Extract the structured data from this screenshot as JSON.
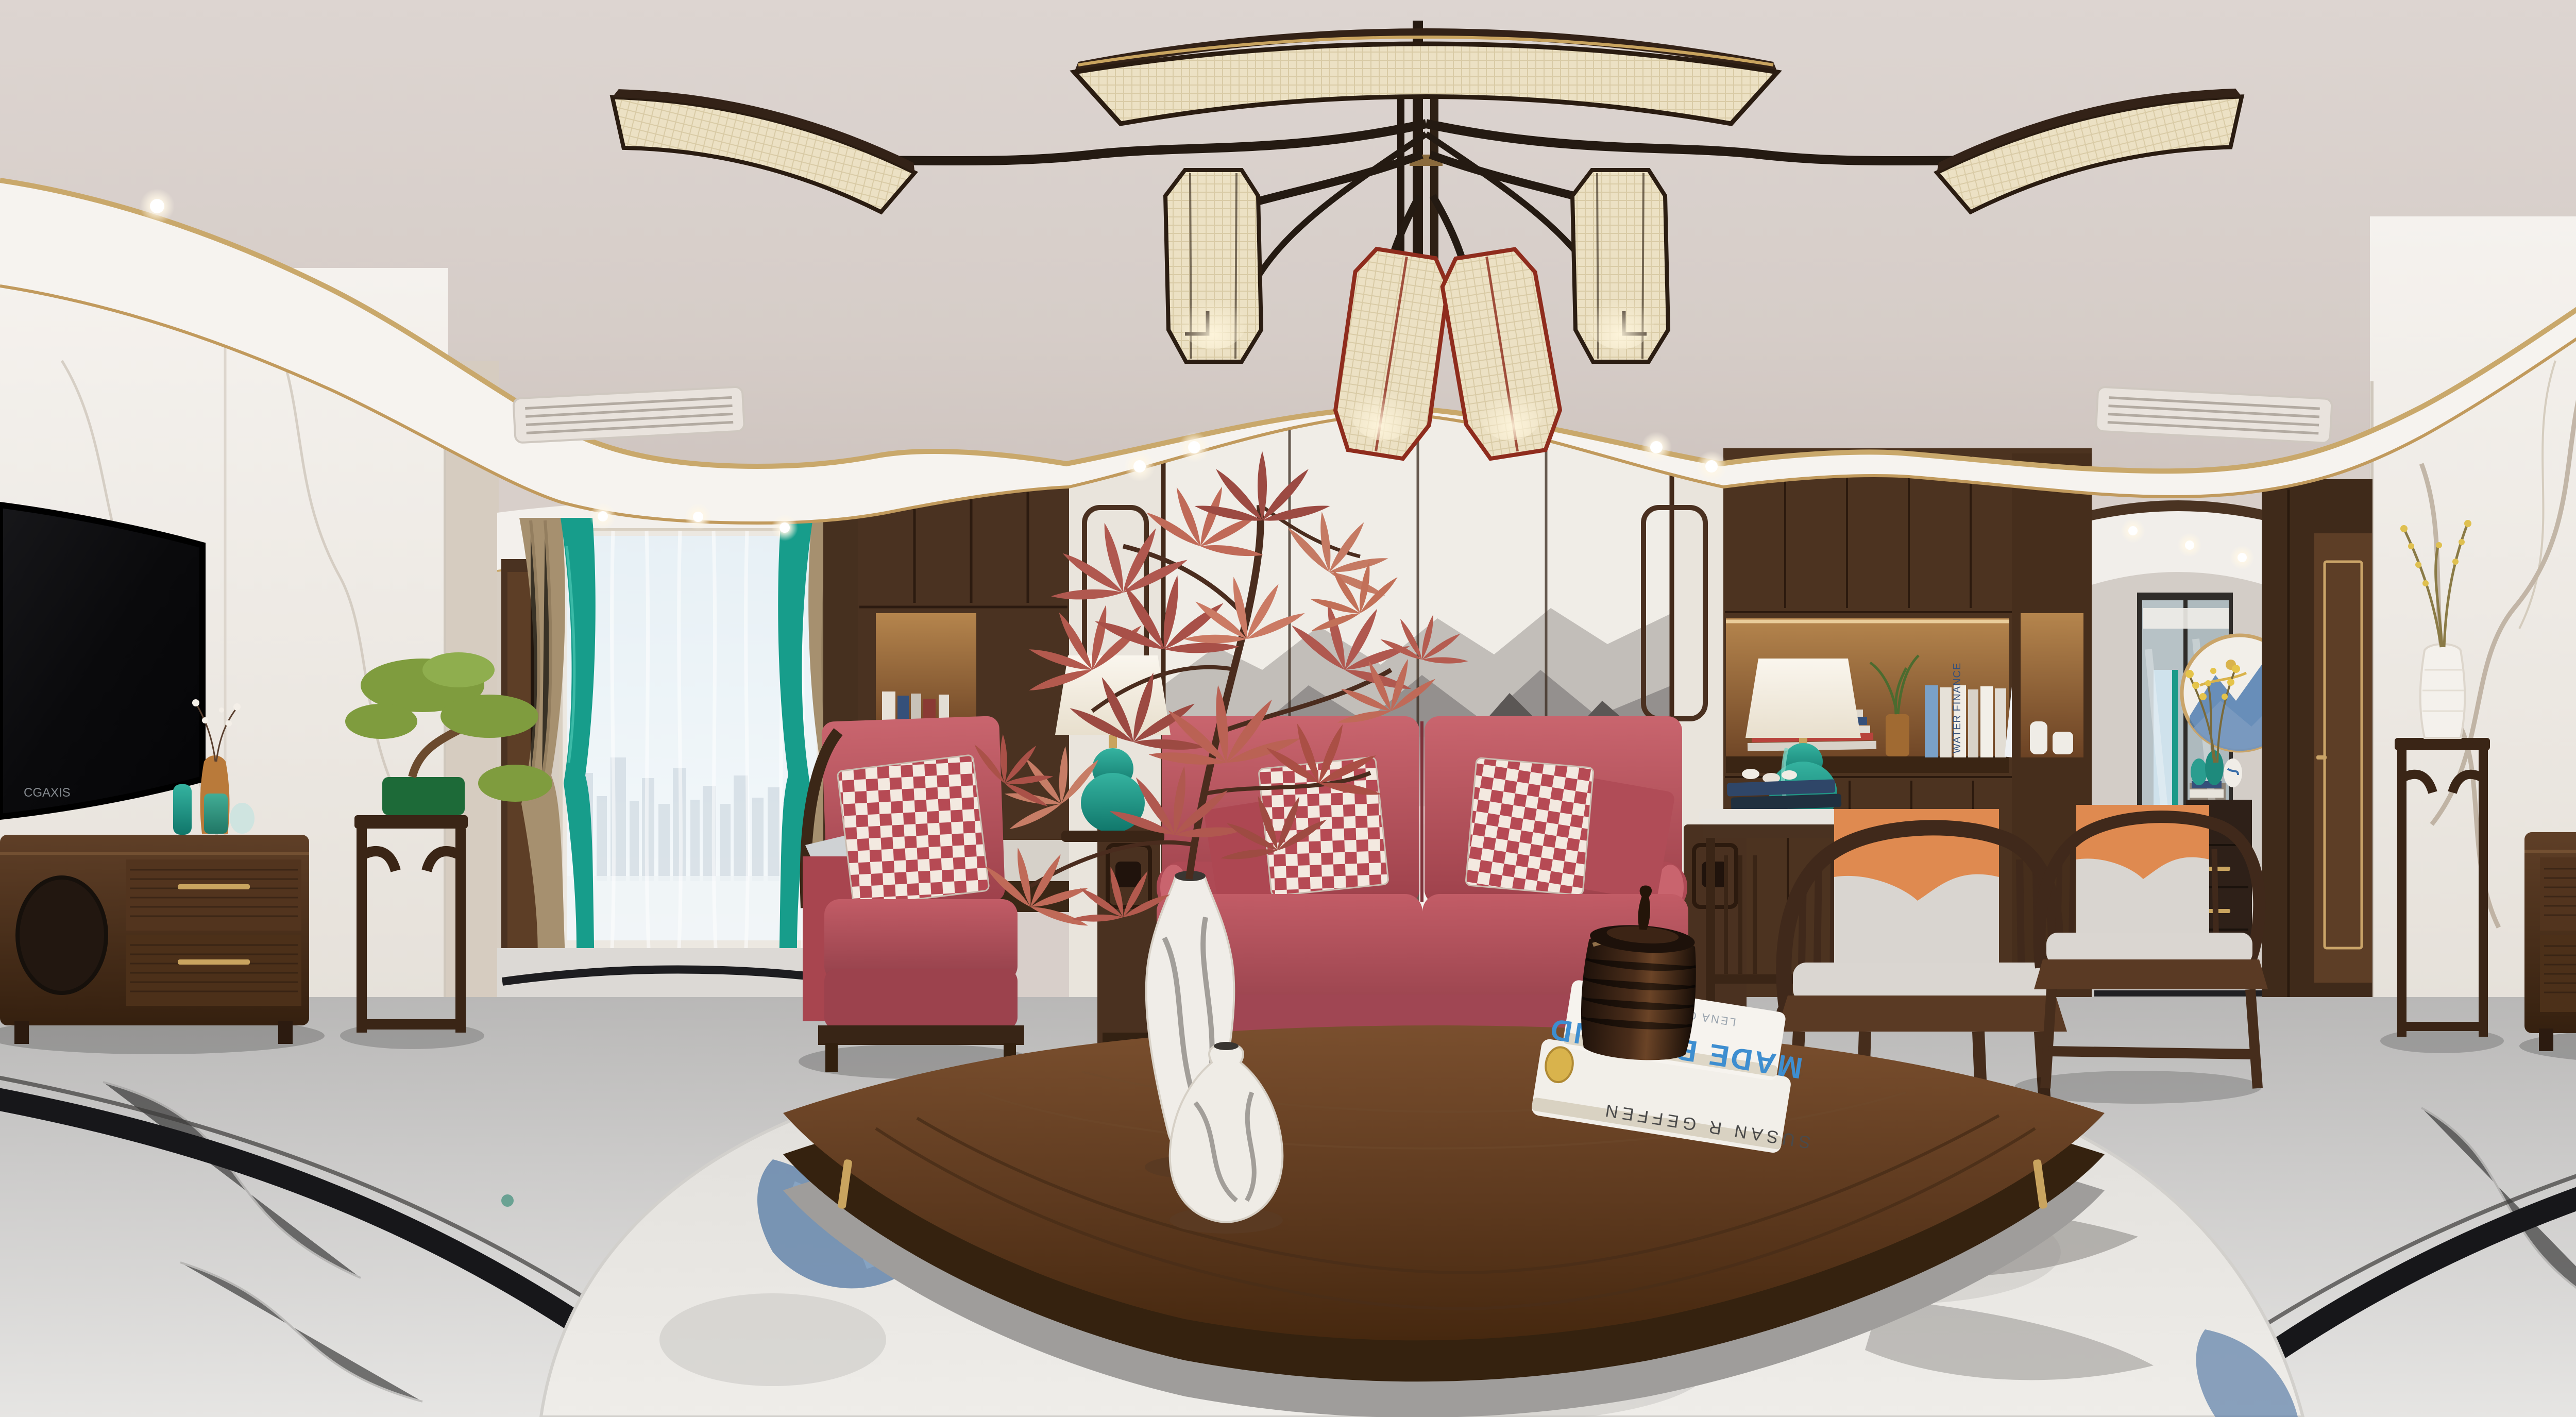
{
  "scene": {
    "title": "New Chinese style living room - 360 degree equirectangular panorama",
    "view": "interior render, red leather sofa, ink-mountain mural wall, twin TV walls (panorama wrap), fan-shaped chandelier"
  },
  "texts": {
    "tv_brand": "CGAXIS",
    "book_top_title": "MADE BY HAND",
    "book_top_author": "LENA CORWIN'S",
    "book_bottom_spine": "SUSAN R GEFFEN",
    "shelf_book_1": "WATER FINANCE",
    "shelf_book_2": "MOBY DICK"
  },
  "palette": {
    "ceiling": "#d8cfca",
    "fascia_white": "#f6f3ef",
    "trim_gold": "#c9a86b",
    "marble_wall": "#f2efeb",
    "wall_beige": "#d8cfc4",
    "wood_dark": "#3f2a1a",
    "wood_mid": "#5d3e26",
    "sofa_red": "#b9515c",
    "pillow_check_red": "#b64a54",
    "pillow_cream": "#f3e9e0",
    "curtain_teal": "#179d8b",
    "curtain_beige": "#a6906f",
    "lamp_teal": "#1e9a88",
    "cushion_gray": "#d9d5d0",
    "cushion_orange": "#df8a50",
    "mural_gray": "#8f8b89",
    "floor_marble": "#c9c8c7",
    "floor_inlay_black": "#17171a",
    "carpet": "#e9e7e2",
    "carpet_blue": "#5d7fa8",
    "screen_black": "#0a0a0c",
    "gold_decor": "#c9a45f"
  }
}
